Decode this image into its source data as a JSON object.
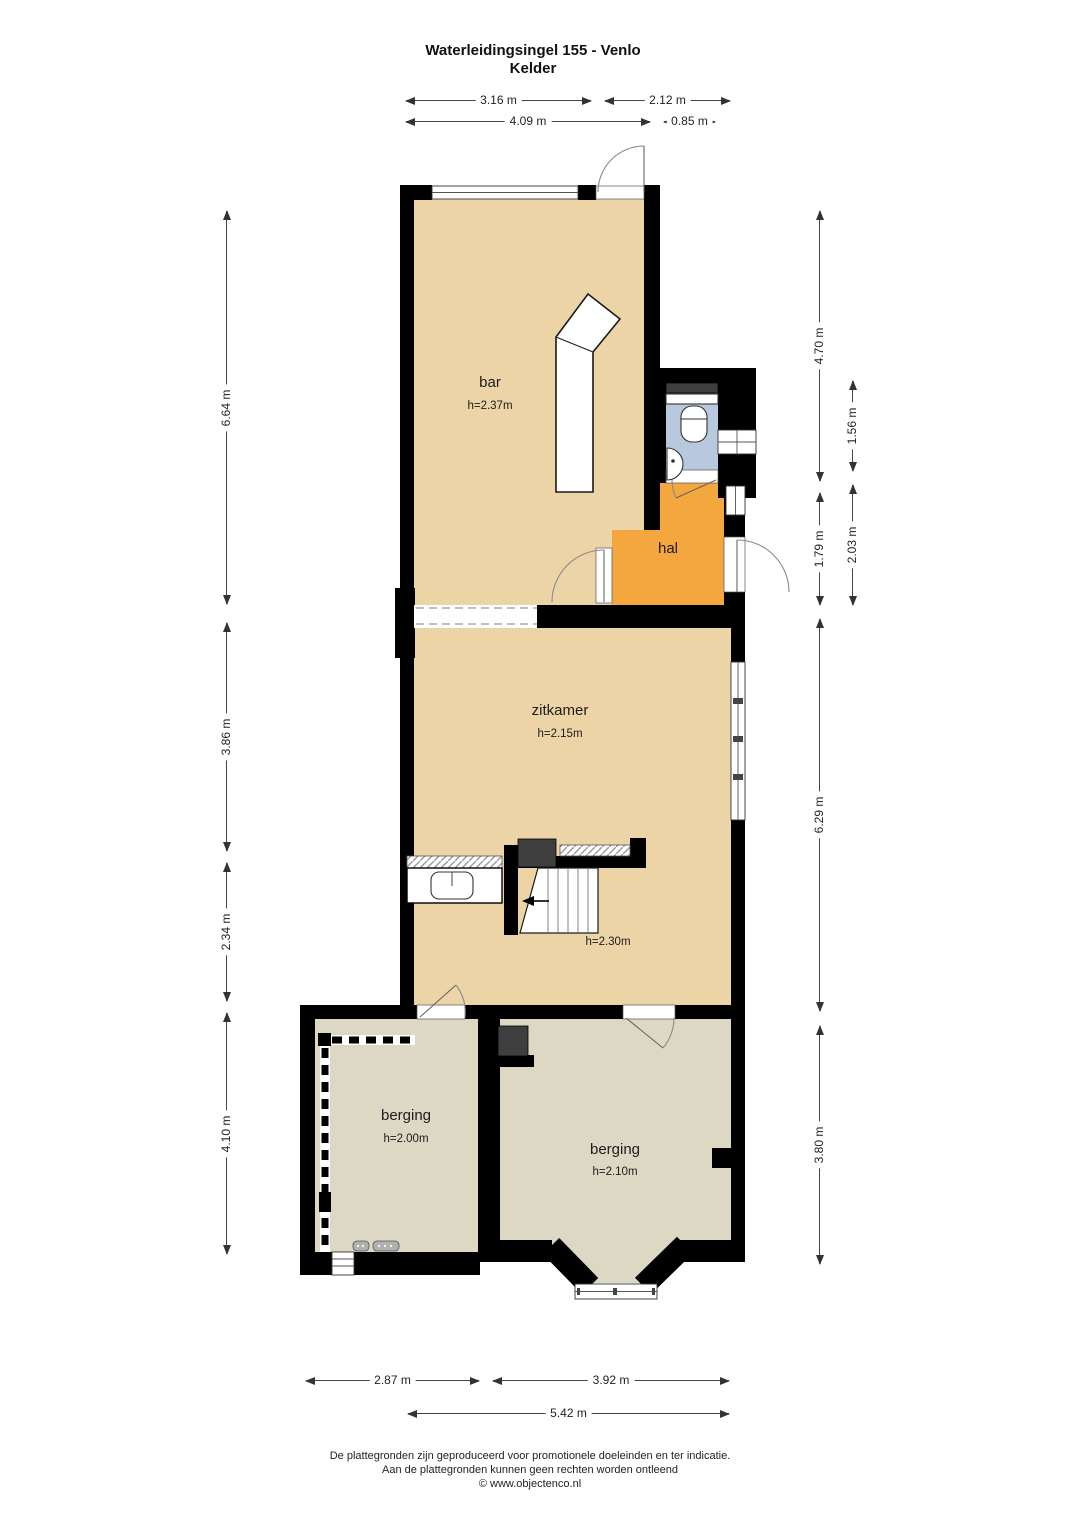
{
  "title": {
    "line1": "Waterleidingsingel 155 - Venlo",
    "line2": "Kelder"
  },
  "rooms": {
    "bar": {
      "name": "bar",
      "height": "h=2.37m"
    },
    "hal": {
      "name": "hal"
    },
    "zitkamer": {
      "name": "zitkamer",
      "height": "h=2.15m"
    },
    "stairs": {
      "height": "h=2.30m"
    },
    "berging_left": {
      "name": "berging",
      "height": "h=2.00m"
    },
    "berging_right": {
      "name": "berging",
      "height": "h=2.10m"
    }
  },
  "dims": {
    "top": [
      "3.16 m",
      "2.12 m",
      "4.09 m",
      "0.85 m"
    ],
    "left": [
      "6.64 m",
      "3.86 m",
      "2.34 m",
      "4.10 m"
    ],
    "right": [
      "4.70 m",
      "1.56 m",
      "1.79 m",
      "2.03 m",
      "6.29 m",
      "3.80 m"
    ],
    "bottom": [
      "2.87 m",
      "3.92 m",
      "5.42 m"
    ]
  },
  "footer": {
    "line1": "De plattegronden zijn geproduceerd voor promotionele doeleinden en ter indicatie.",
    "line2": "Aan de plattegronden kunnen geen rechten worden ontleend",
    "line3": "© www.objectenco.nl"
  },
  "colors": {
    "floor_main": "#edd4a6",
    "floor_hal": "#f4a73f",
    "floor_toilet": "#b7c8df",
    "floor_berging": "#ddd8c3",
    "wall": "#000000",
    "dark_block": "#3f3f3f"
  }
}
